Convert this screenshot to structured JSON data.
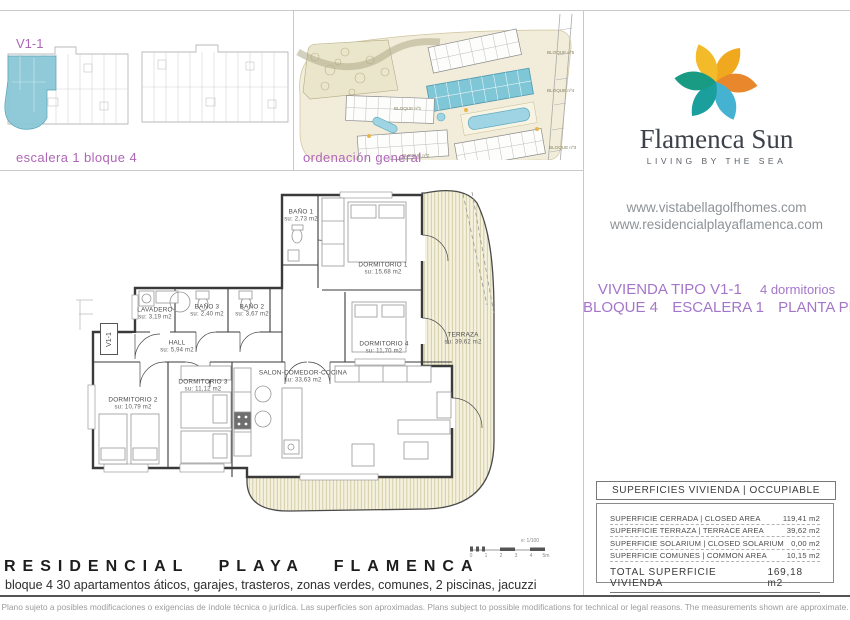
{
  "panels": {
    "elevation": {
      "unit_label": "V1-1",
      "caption": "escalera 1 bloque 4"
    },
    "siteplan": {
      "caption": "ordenación general",
      "block_labels": [
        "BLOQUE nº1",
        "BLOQUE nº2",
        "BLOQUE nº3",
        "BLOQUE nº4",
        "BLOQUE nº5"
      ]
    }
  },
  "brand": {
    "name": "Flamenca Sun",
    "tagline": "LIVING BY THE SEA",
    "website1": "www.vistabellagolfhomes.com",
    "website2": "www.residencialplayaflamenca.com"
  },
  "unit": {
    "type_label": "VIVIENDA TIPO V1-1",
    "bedrooms": "4 dormitorios",
    "block": "BLOQUE 4",
    "stair": "ESCALERA 1",
    "floor": "PLANTA PRIMERA"
  },
  "floorplan": {
    "entry_label": "V1-1",
    "scale_label": "e: 1/100",
    "scale_ticks": [
      "0",
      "1",
      "2",
      "3",
      "4",
      "5m"
    ],
    "rooms": [
      {
        "name": "BAÑO 1",
        "area": "su: 2,73 m2"
      },
      {
        "name": "DORMITORIO 1",
        "area": "su: 15,68 m2"
      },
      {
        "name": "LAVADERO",
        "area": "su: 3,19 m2"
      },
      {
        "name": "BAÑO 3",
        "area": "su: 2,40 m2"
      },
      {
        "name": "BAÑO 2",
        "area": "su: 3,67 m2"
      },
      {
        "name": "HALL",
        "area": "su: 5,94 m2"
      },
      {
        "name": "DORMITORIO 4",
        "area": "su: 11,70 m2"
      },
      {
        "name": "TERRAZA",
        "area": "su: 39,62 m2"
      },
      {
        "name": "DORMITORIO 3",
        "area": "su: 11,12 m2"
      },
      {
        "name": "SALON-COMEDOR-COCINA",
        "area": "su: 33,63 m2"
      },
      {
        "name": "DORMITORIO 2",
        "area": "su: 10,79 m2"
      }
    ]
  },
  "areas_table": {
    "header": "SUPERFICIES VIVIENDA | OCCUPIABLE AREA",
    "rows": [
      {
        "label": "SUPERFICIE CERRADA | CLOSED AREA",
        "value": "119,41 m2"
      },
      {
        "label": "SUPERFICIE TERRAZA  | TERRACE AREA",
        "value": "39,62 m2"
      },
      {
        "label": "SUPERFICIE SOLARIUM | CLOSED SOLARIUM",
        "value": "0,00 m2"
      },
      {
        "label": "SUPERFICIE COMUNES | COMMON AREA",
        "value": "10,15 m2"
      }
    ],
    "total_label": "TOTAL SUPERFICIE VIVIENDA",
    "total_value": "169,18 m2"
  },
  "footer": {
    "title": "RESIDENCIAL PLAYA FLAMENCA",
    "subtitle": "bloque 4 30 apartamentos áticos, garajes, trasteros, zonas verdes, comunes, 2 piscinas, jacuzzi",
    "fine_print": "Plano sujeto a posibles modificaciones o exigencias de índole técnica o jurídica. Las superficies son aproximadas. Plans subject to possible modifications for technical or legal reasons. The measurements shown are approximate."
  },
  "colors": {
    "accent_purple": "#a476ca",
    "caption_purple": "#b066b8",
    "highlight_teal": "#8ac7d6",
    "terrace_fill": "#f4f1de",
    "logo_orange": "#e8872b",
    "logo_yellow": "#f0a81e",
    "logo_teal": "#1a9f9c",
    "logo_blue": "#45b2d2"
  }
}
